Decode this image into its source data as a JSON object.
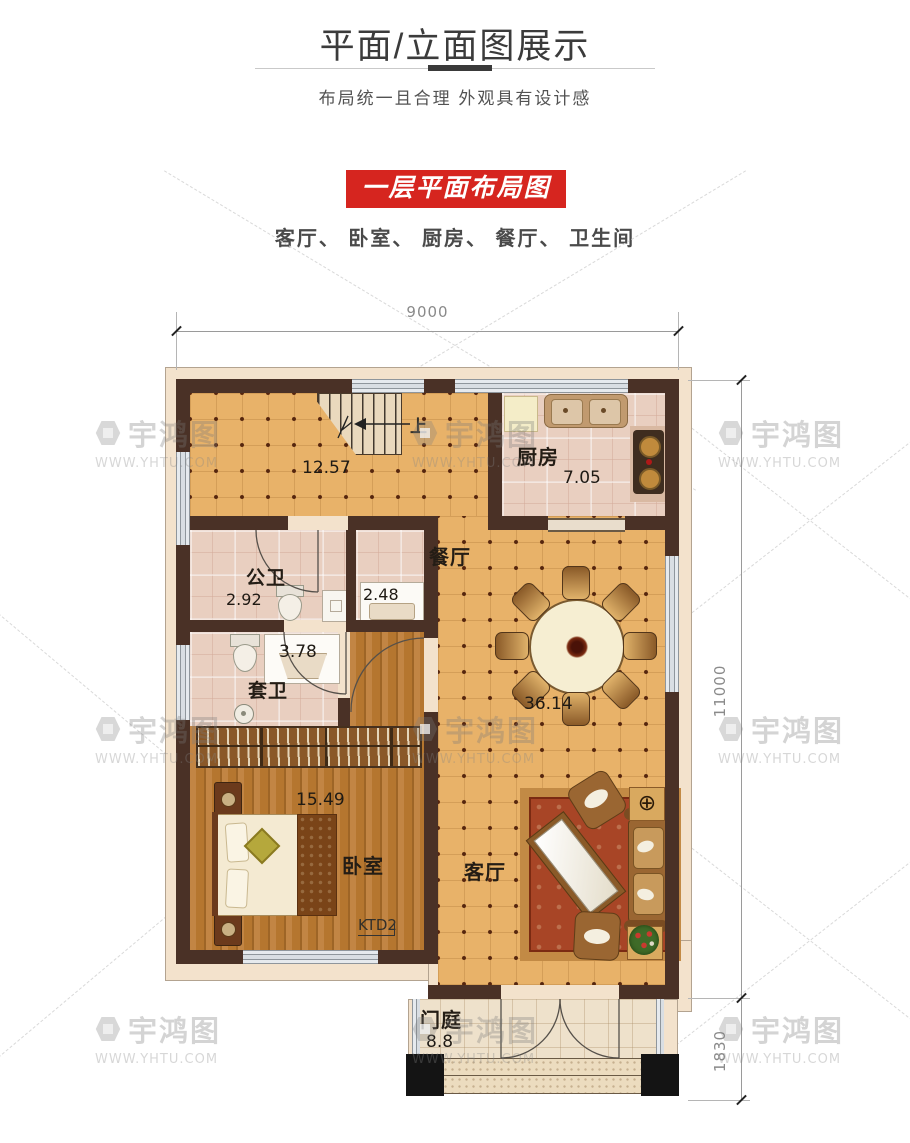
{
  "header": {
    "title": "平面/立面图展示",
    "subtitle": "布局统一且合理 外观具有设计感"
  },
  "plan_header": {
    "banner": "一层平面布局图",
    "room_list": "客厅、 卧室、 厨房、 餐厅、 卫生间"
  },
  "floorplan": {
    "dimensions": {
      "width_top": "9000",
      "height_right": "11000",
      "porch_height": "1830"
    },
    "rooms": {
      "stair_hall": {
        "area": "12.57",
        "stair_label": "上"
      },
      "kitchen": {
        "name": "厨房",
        "area": "7.05"
      },
      "dining": {
        "name": "餐厅",
        "combined_area": "36.14"
      },
      "public_bath": {
        "name": "公卫",
        "area": "2.92"
      },
      "bath_vanity": {
        "area": "2.48"
      },
      "ensuite_bath": {
        "name": "套卫",
        "area": "3.78"
      },
      "bedroom": {
        "name": "卧室",
        "area": "15.49",
        "window_label": "KTD2"
      },
      "living": {
        "name": "客厅"
      },
      "porch": {
        "name": "门庭",
        "area": "8.8"
      }
    }
  },
  "watermark": {
    "brand": "宇鸿图",
    "url": "WWW.YHTU.COM"
  },
  "colors": {
    "accent_red": "#d6251f",
    "wall": "#4a3126",
    "floor_tan": "#e8b269",
    "floor_pink": "#e9cfc0",
    "floor_wood": "#b5762f"
  }
}
